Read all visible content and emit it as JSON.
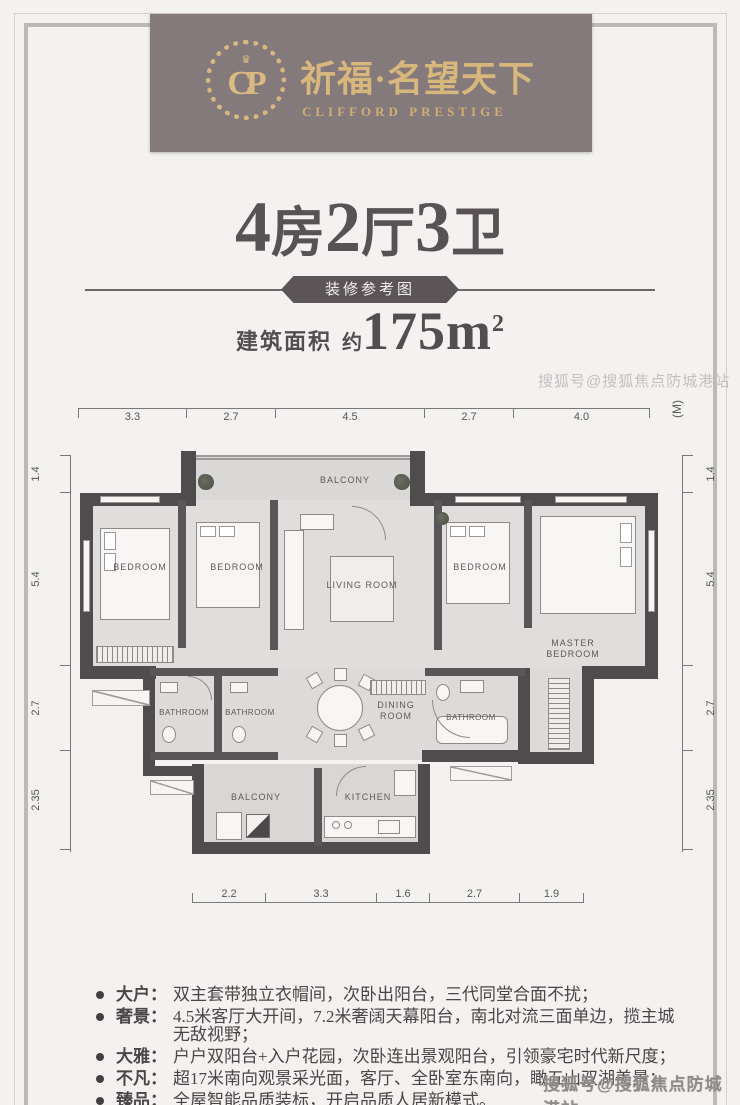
{
  "header": {
    "monogram": "CP",
    "crown": "♛",
    "brand_cn": "祈福·名望天下",
    "brand_en": "CLIFFORD PRESTIGE"
  },
  "title": {
    "headline_parts": [
      "4",
      "房",
      "2",
      "厅",
      "3",
      "卫"
    ],
    "badge": "装修参考图",
    "area_label": "建筑面积",
    "area_approx": "约",
    "area_value": "175m",
    "area_sup": "2"
  },
  "floorplan": {
    "unit": "(M)",
    "dims_top": [
      "3.3",
      "2.7",
      "4.5",
      "2.7",
      "4.0"
    ],
    "dims_bottom": [
      "2.2",
      "3.3",
      "1.6",
      "2.7",
      "1.9"
    ],
    "dims_left": [
      "1.4",
      "5.4",
      "2.7",
      "2.35"
    ],
    "dims_right": [
      "1.4",
      "5.4",
      "2.7",
      "2.35"
    ],
    "rooms": {
      "balcony_top": "BALCONY",
      "bedroom_left": "BEDROOM",
      "bedroom_mid": "BEDROOM",
      "living": "LIVING ROOM",
      "bedroom_right": "BEDROOM",
      "master": "MASTER BEDROOM",
      "bathroom_1": "BATHROOM",
      "bathroom_2": "BATHROOM",
      "dining": "DINING ROOM",
      "bathroom_3": "BATHROOM",
      "balcony_bottom": "BALCONY",
      "kitchen": "KITCHEN"
    }
  },
  "features": {
    "items": [
      {
        "label": "大户：",
        "text": "双主套带独立衣帽间，次卧出阳台，三代同堂合面不扰；"
      },
      {
        "label": "奢景：",
        "text": "4.5米客厅大开间，7.2米奢阔天幕阳台，南北对流三面单边，揽主城无敌视野；"
      },
      {
        "label": "大雅：",
        "text": "户户双阳台+入户花园，次卧连出景观阳台，引领豪宅时代新尺度；"
      },
      {
        "label": "不凡：",
        "text": "超17米南向观景采光面，客厅、全卧室东南向，瞰五山双湖美景；"
      },
      {
        "label": "臻品：",
        "text": "全屋智能品质装标，开启品质人居新模式。"
      }
    ]
  },
  "watermarks": {
    "mid": "搜狐号@搜狐焦点防城港站",
    "bottom": "搜狐号@搜狐焦点防城港站"
  },
  "colors": {
    "banner_bg": "#857a7b",
    "gold": "#d8b77c",
    "ink": "#595254",
    "wall": "#4f4c4d"
  }
}
